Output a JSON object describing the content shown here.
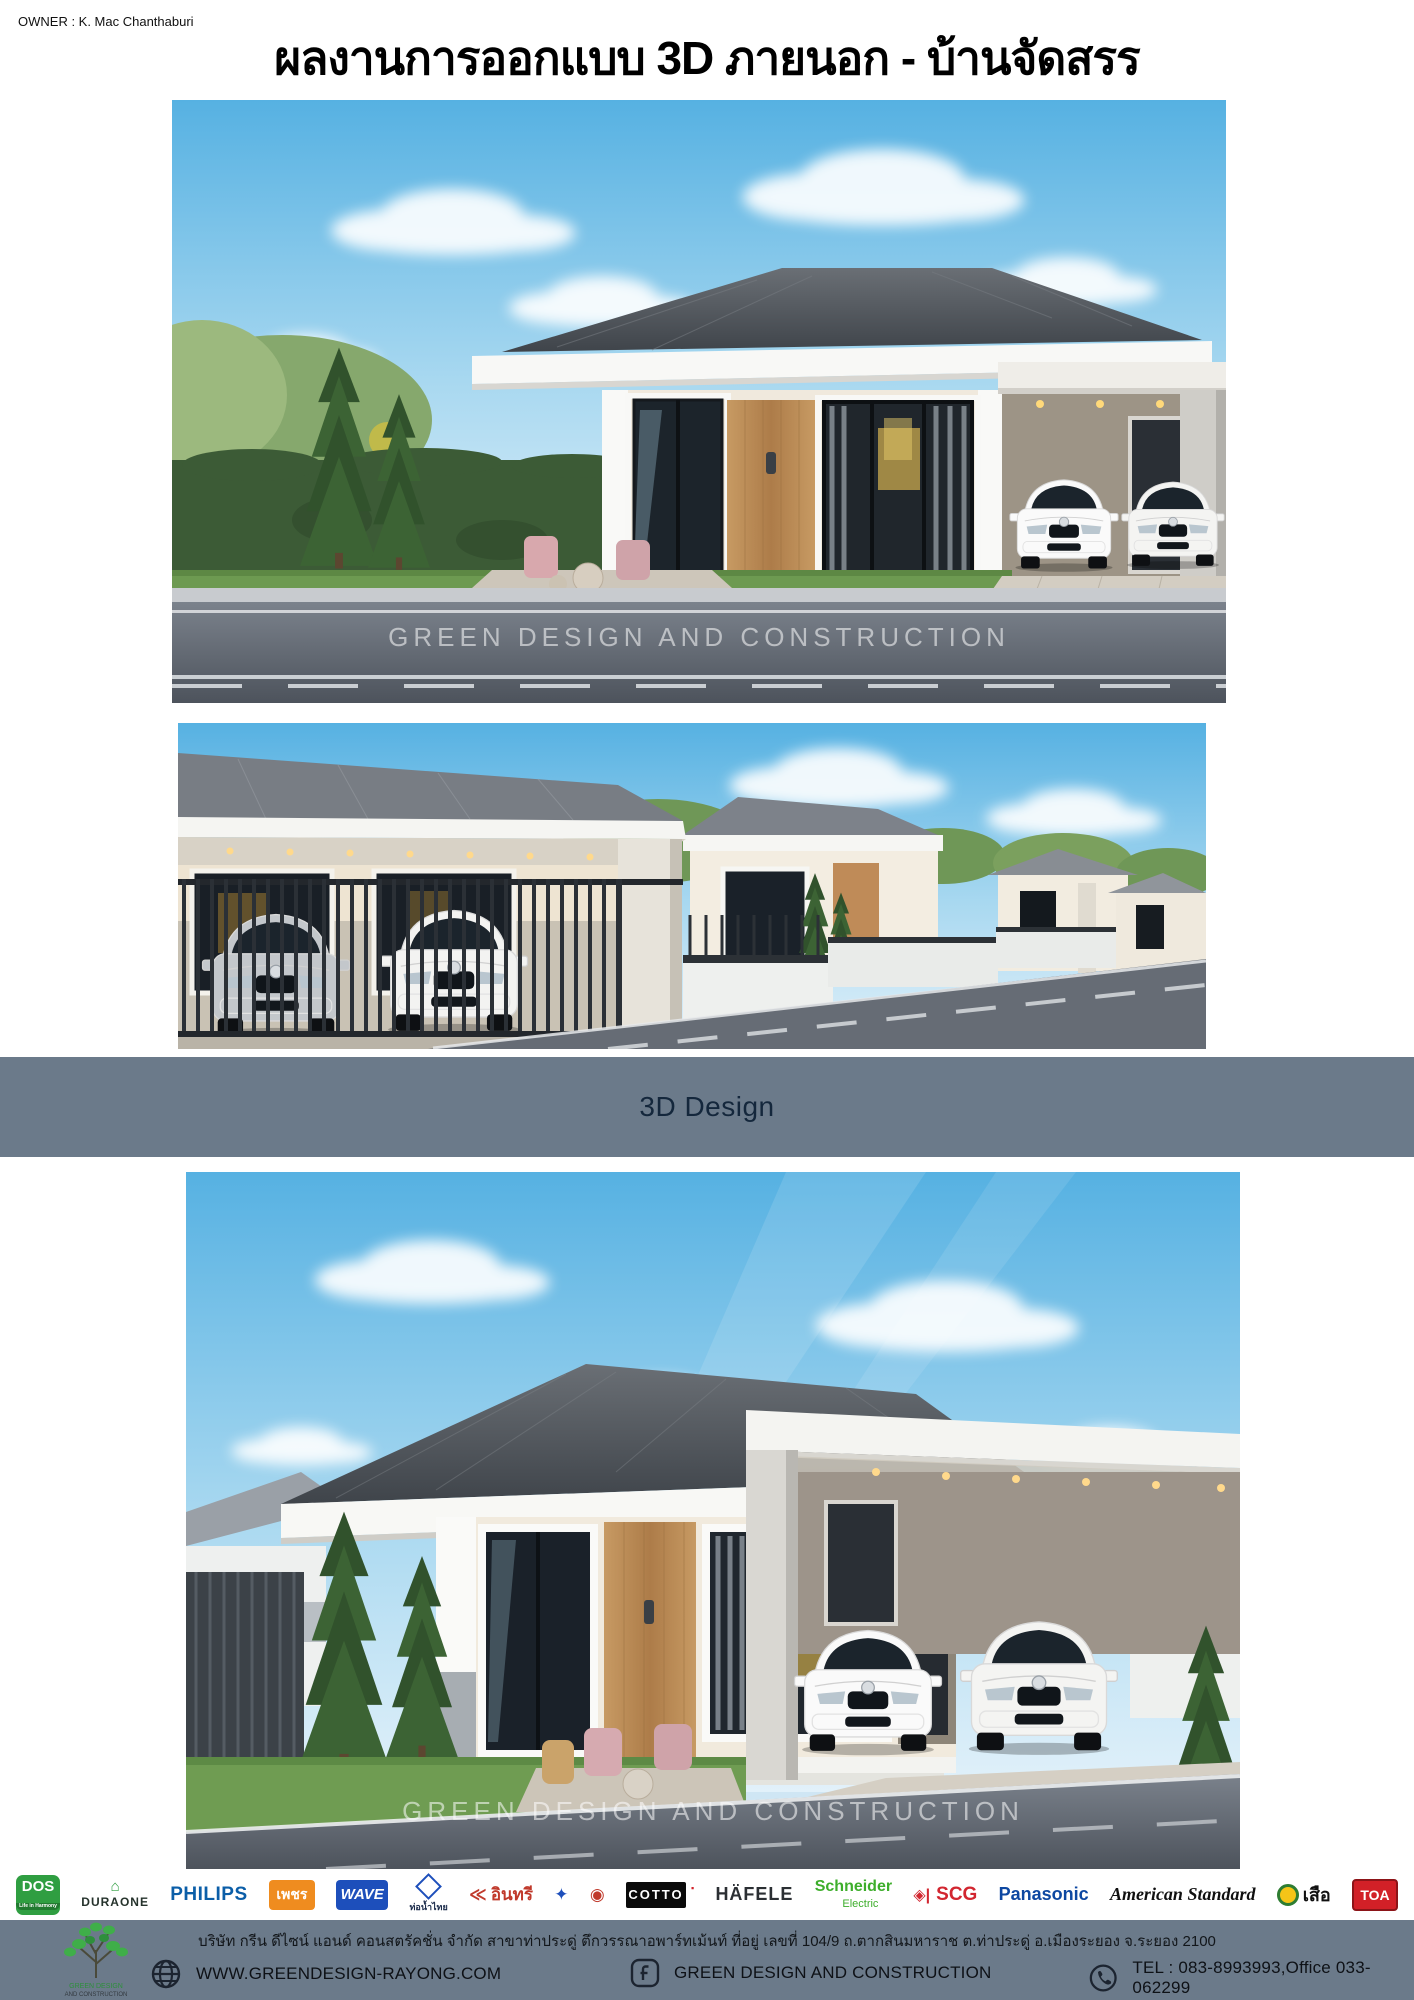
{
  "header": {
    "owner": "OWNER : K. Mac Chanthaburi",
    "title": "ผลงานการออกแบบ 3D ภายนอก - บ้านจัดสรร"
  },
  "banner": {
    "label": "3D Design",
    "bg_color": "#6b7a8a",
    "text_color": "#14273c"
  },
  "photos": {
    "watermark": "GREEN DESIGN AND CONSTRUCTION",
    "photo1_alt": "3D render - single storey house with carport and two white cars",
    "photo2_alt": "3D render - row of housing estate homes along a street",
    "photo3_alt": "3D render - angled exterior view of house with two white cars"
  },
  "brands": [
    {
      "label": "DOS",
      "sub": "Life in Harmony"
    },
    {
      "label": "DURAONE",
      "glyph": "⌂"
    },
    {
      "label": "PHILIPS"
    },
    {
      "label": "เพชร"
    },
    {
      "label": "WAVE"
    },
    {
      "label": "ท่อน้ำไทย"
    },
    {
      "label": "อินทรี",
      "glyph": "≪"
    },
    {
      "glyph": "✦",
      "label": ""
    },
    {
      "glyph": "◉",
      "label": ""
    },
    {
      "label": "COTTO",
      "sup": "▪"
    },
    {
      "label": "HÄFELE"
    },
    {
      "label": "Schneider",
      "sub": "Electric"
    },
    {
      "label": "SCG",
      "glyph": "◈|"
    },
    {
      "label": "Panasonic"
    },
    {
      "label": "American Standard"
    },
    {
      "label": "เสือ"
    },
    {
      "label": "TOA"
    }
  ],
  "footer": {
    "address": "บริษัท กรีน ดีไซน์ แอนด์ คอนสตรัคชั่น จำกัด สาขาท่าประดู่ ตึกวรรณาอพาร์ทเม้นท์ ที่อยู่ เลขที่ 104/9  ถ.ตากสินมหาราช  ต.ท่าประดู่ อ.เมืองระยอง  จ.ระยอง 2100",
    "website": "WWW.GREENDESIGN-RAYONG.COM",
    "company": "GREEN DESIGN AND CONSTRUCTION",
    "tel": "TEL : 083-8993993,Office 033-062299",
    "logo_line1": "GREEN DESIGN",
    "logo_line2": "AND CONSTRUCTION"
  }
}
